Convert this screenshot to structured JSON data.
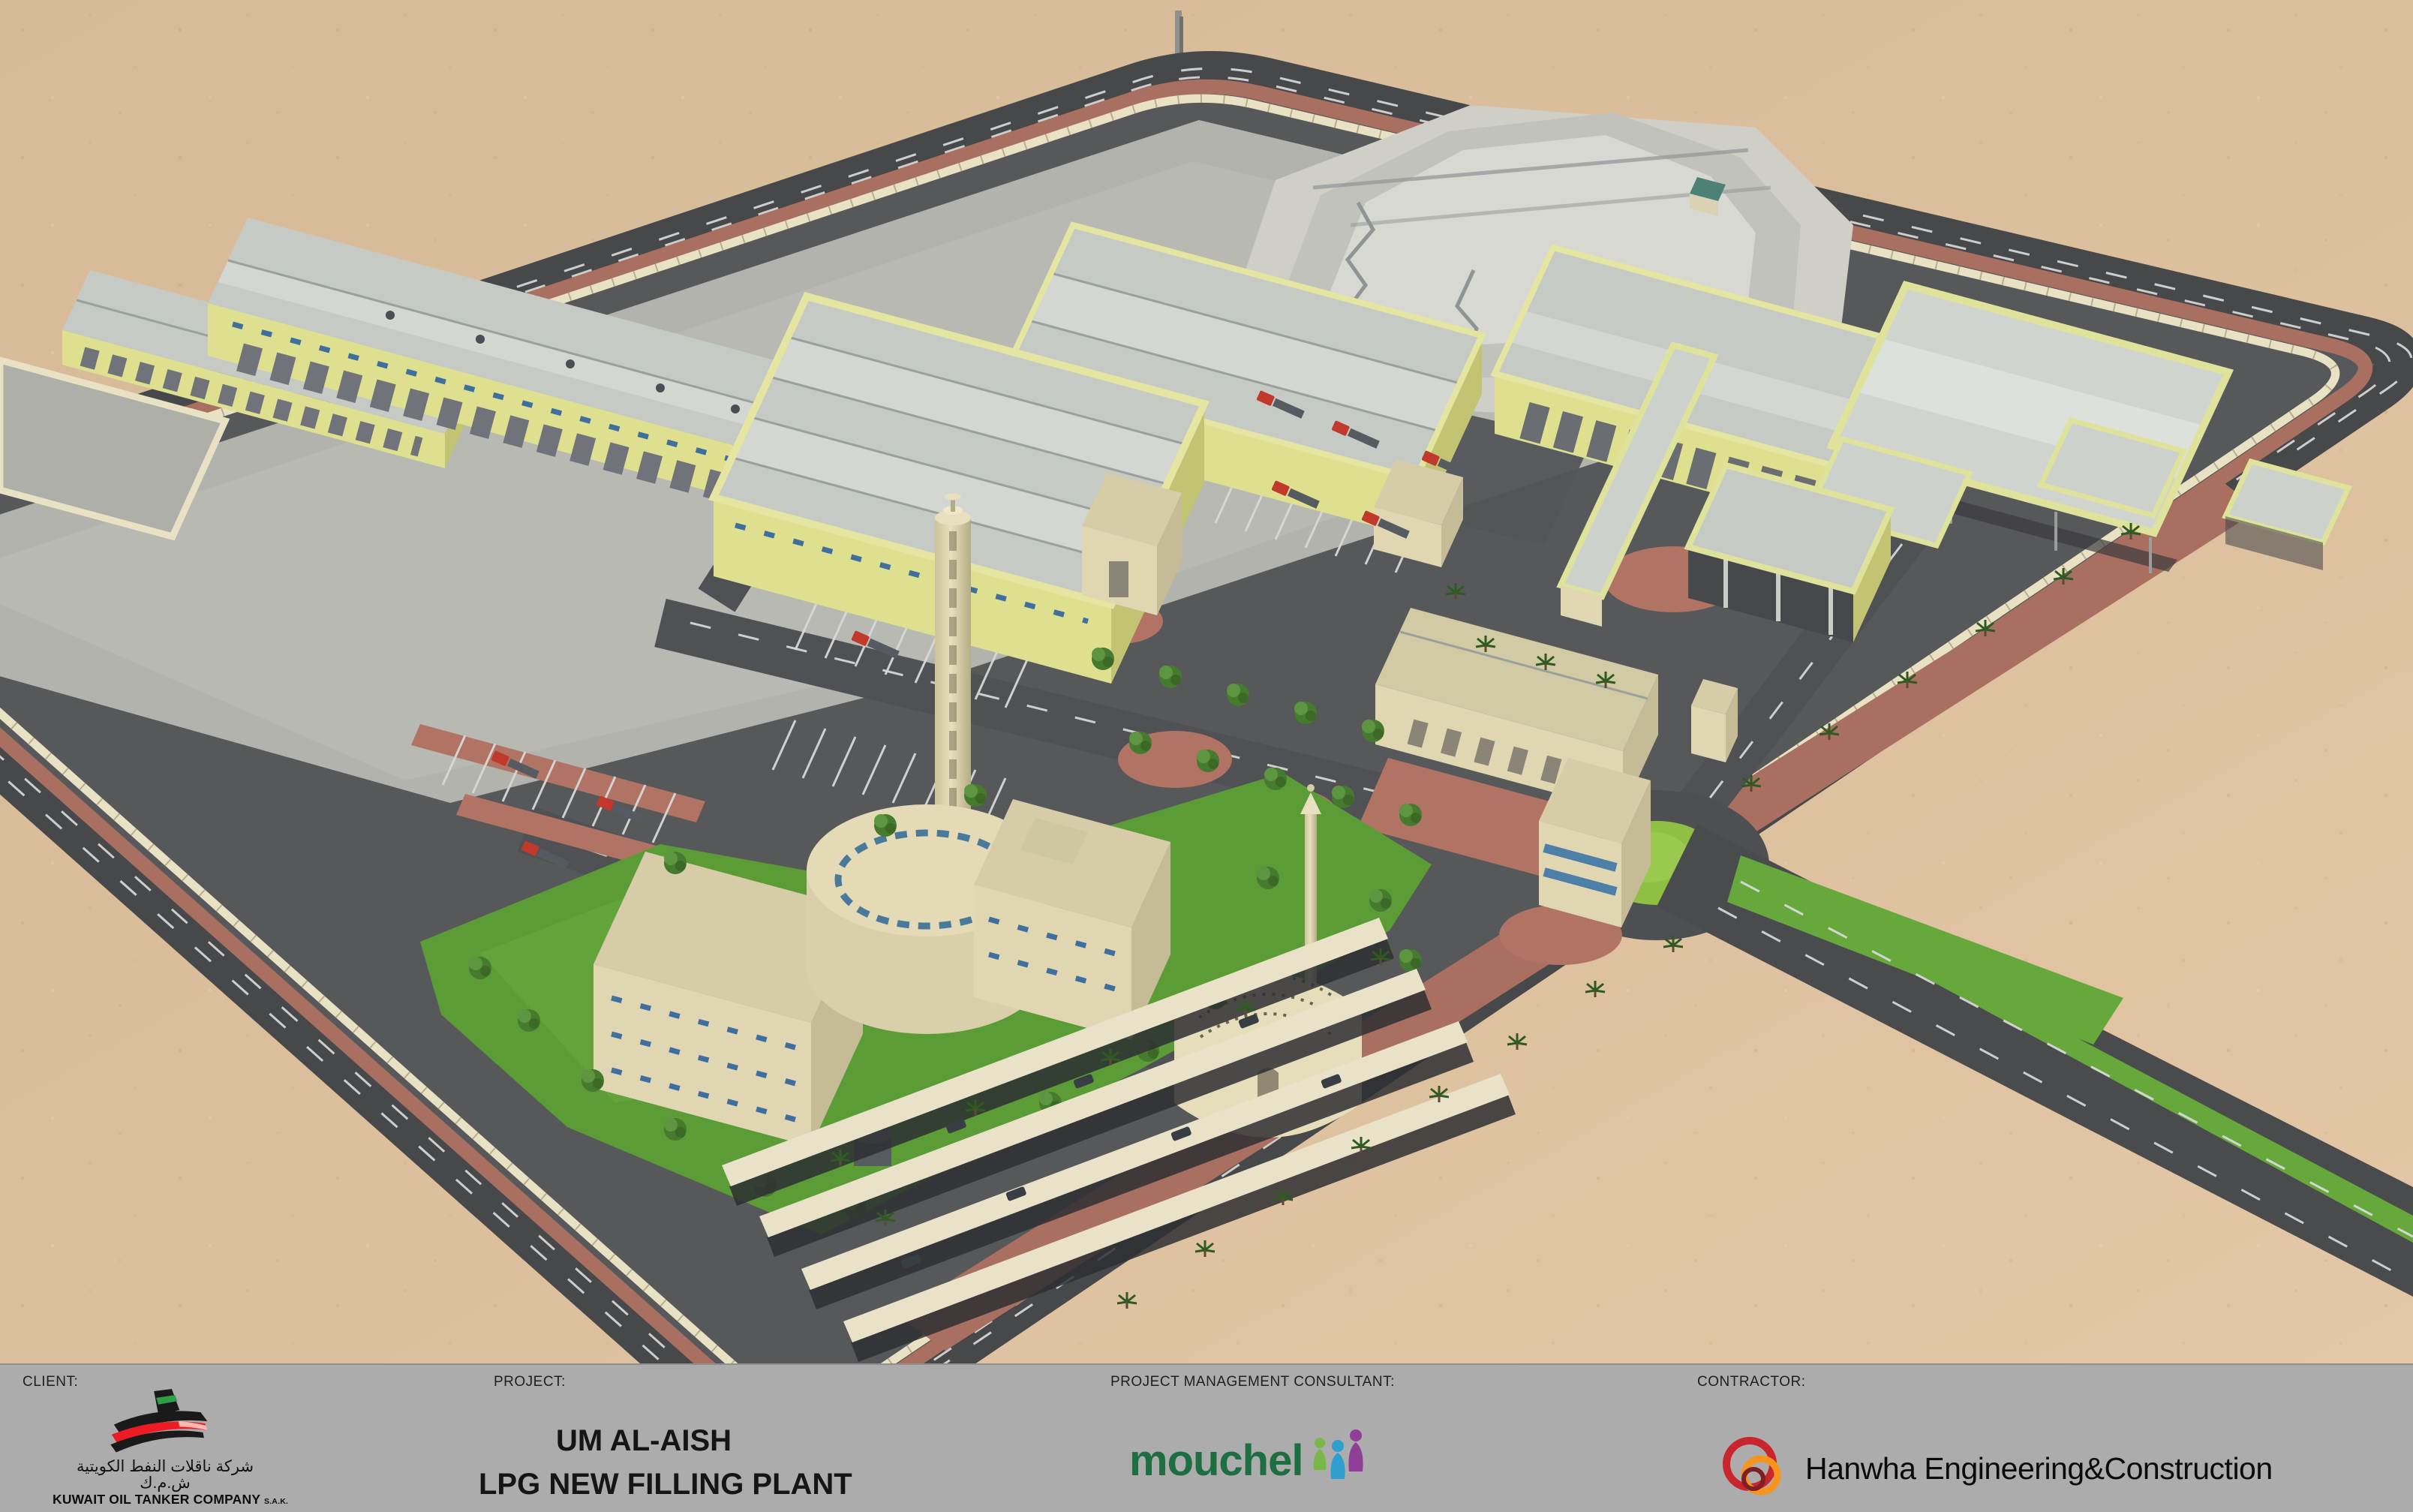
{
  "title_block": {
    "client": {
      "label": "CLIENT:",
      "company_en": "KUWAIT OIL TANKER COMPANY",
      "company_suffix": "S.A.K.",
      "company_ar": "شركة ناقلات النفط الكويتية ش.م.ك"
    },
    "project": {
      "label": "PROJECT:",
      "name_line1": "UM AL-AISH",
      "name_line2": "LPG NEW FILLING PLANT"
    },
    "consultant": {
      "label": "PROJECT MANAGEMENT CONSULTANT:",
      "name": "mouchel"
    },
    "contractor": {
      "label": "CONTRACTOR:",
      "name": "Hanwha Engineering&Construction"
    }
  },
  "palette": {
    "sand": "#d9bd9c",
    "sand_warm": "#e1c5a4",
    "perimeter_road": "#474849",
    "interior_asphalt": "#57585a",
    "concrete": "#b2b3ad",
    "sidewalk_red": "#a96f60",
    "paving_red": "#b07364",
    "wall_cream": "#e9e1c3",
    "building_yellow": "#dee08f",
    "building_yellow_dark": "#c2c473",
    "roof_gray": "#c6cac5",
    "cream_building": "#e0d6b2",
    "glass_blue": "#4d7fa8",
    "grass": "#5b9c36",
    "grass_bright": "#8fc043",
    "mouchel_green": "#1d6e41",
    "hanwha_red": "#c9252c",
    "hanwha_orange": "#f7941d",
    "kotc_green": "#2e9e49",
    "kotc_red": "#ed1c24",
    "titlebar_gray": "#acacac"
  },
  "scene": {
    "type": "3d-architectural-site-rendering",
    "elements": [
      "desert",
      "perimeter-road",
      "boundary-wall",
      "warehouses",
      "storage-mound",
      "filling-sheds",
      "water-tower",
      "admin-offices",
      "mosque",
      "truck-parking",
      "car-shade-canopies",
      "roundabout",
      "entrance-road",
      "landscaping"
    ]
  }
}
